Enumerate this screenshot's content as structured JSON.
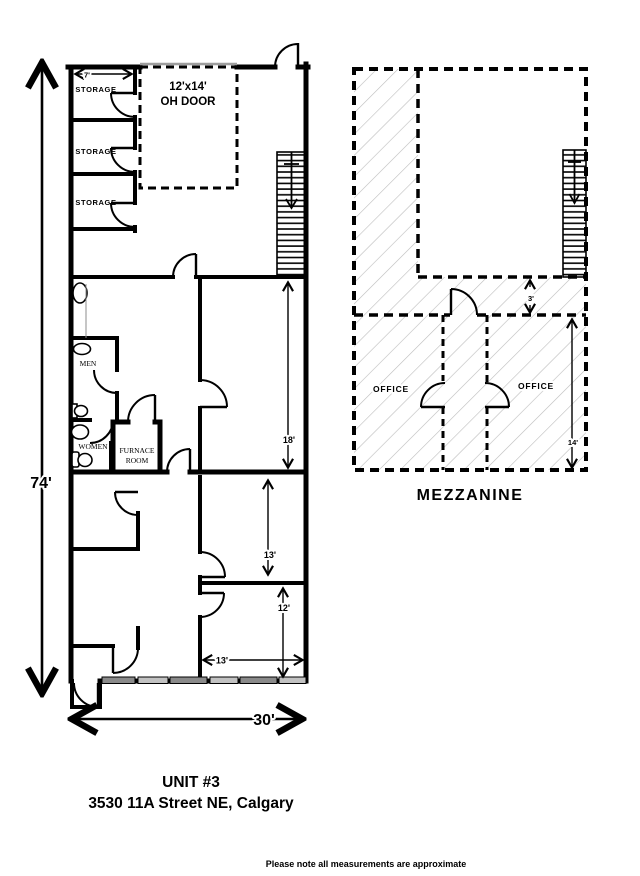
{
  "document": {
    "title_line1": "UNIT #3",
    "title_line2": "3530 11A Street NE, Calgary",
    "footer_note": "Please note all measurements are approximate"
  },
  "main_floor": {
    "storage_label_1": "STORAGE",
    "storage_label_2": "STORAGE",
    "storage_label_3": "STORAGE",
    "oh_door_line1": "12'x14'",
    "oh_door_line2": "OH DOOR",
    "men_label": "MEN",
    "women_label": "WOMEN",
    "furnace_line1": "FURNACE",
    "furnace_line2": "ROOM",
    "dim_storage_width": "7'",
    "dim_shop_depth": "18'",
    "dim_room_13": "13'",
    "dim_room_12": "12'",
    "dim_room_13_width": "13'",
    "dim_total_width": "30'",
    "dim_total_depth": "74'"
  },
  "mezzanine": {
    "label": "MEZZANINE",
    "office_left_label": "OFFICE",
    "office_right_label": "OFFICE",
    "dim_gap": "3'",
    "dim_depth": "14'"
  },
  "colors": {
    "wall": "#000000",
    "hatch": "#bcbcbc",
    "window_dark": "#8a8a8a",
    "window_light": "#c2c2c2",
    "oh_door_header": "#9e9e9e"
  }
}
